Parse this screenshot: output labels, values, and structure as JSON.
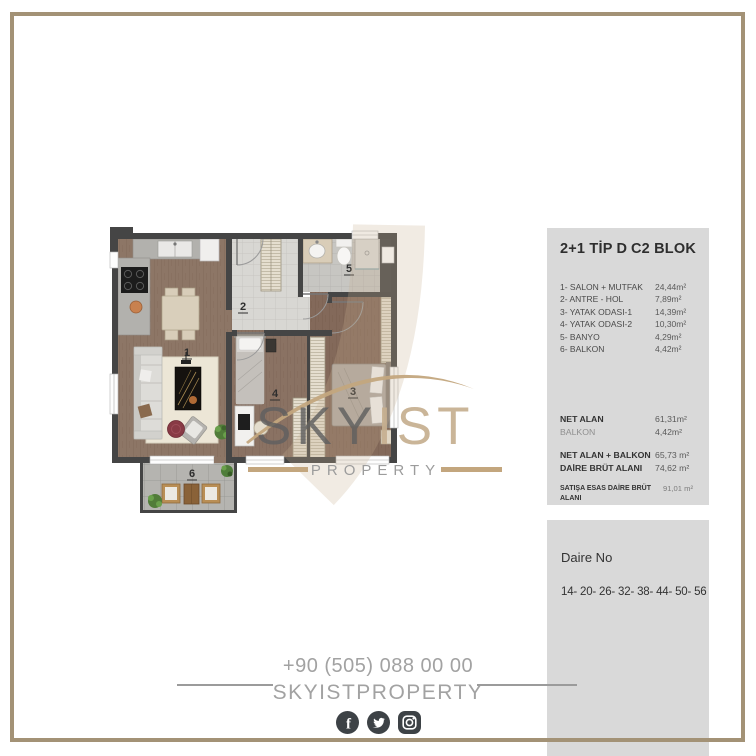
{
  "panel_info": {
    "type_label": "2+1 TİP D",
    "block_label": "C2 BLOK",
    "rooms": [
      {
        "name": "1- SALON + MUTFAK",
        "area": "24,44m²"
      },
      {
        "name": "2- ANTRE - HOL",
        "area": "7,89m²"
      },
      {
        "name": "3- YATAK ODASI-1",
        "area": "14,39m²"
      },
      {
        "name": "4- YATAK ODASI-2",
        "area": "10,30m²"
      },
      {
        "name": "5- BANYO",
        "area": "4,29m²"
      },
      {
        "name": "6- BALKON",
        "area": "4,42m²"
      }
    ],
    "summary1": [
      {
        "name": "NET ALAN",
        "area": "61,31m²"
      },
      {
        "name": "BALKON",
        "area": "4,42m²"
      }
    ],
    "summary2": [
      {
        "name": "NET ALAN + BALKON",
        "area": "65,73 m²"
      },
      {
        "name": "DAİRE BRÜT ALANI",
        "area": "74,62 m²"
      }
    ],
    "sales": {
      "name": "SATIŞA ESAS DAİRE BRÜT ALANI",
      "area": "91,01 m²"
    }
  },
  "panel_daire": {
    "title": "Daire No",
    "numbers": "14- 20- 26- 32- 38- 44- 50- 56"
  },
  "contact": {
    "phone": "+90 (505) 088 00 00",
    "name": "SKYISTPROPERTY"
  },
  "watermark": {
    "part1": "SKY",
    "part2": "IST",
    "subtitle": "PROPERTY"
  },
  "floorplan": {
    "room_labels": [
      "1",
      "2",
      "3",
      "4",
      "5",
      "6"
    ]
  },
  "social_icons": [
    {
      "name": "facebook"
    },
    {
      "name": "twitter"
    },
    {
      "name": "instagram"
    }
  ],
  "colors": {
    "frame": "#a39276",
    "panel_bg": "#d9d9d9",
    "accent_beige": "#c3a67e",
    "icon_bg": "#3d4246",
    "contact_gray": "#a2a2a2",
    "wall": "#454545",
    "wood_floor": "#8d7666",
    "tile": "#d8d7d3"
  }
}
